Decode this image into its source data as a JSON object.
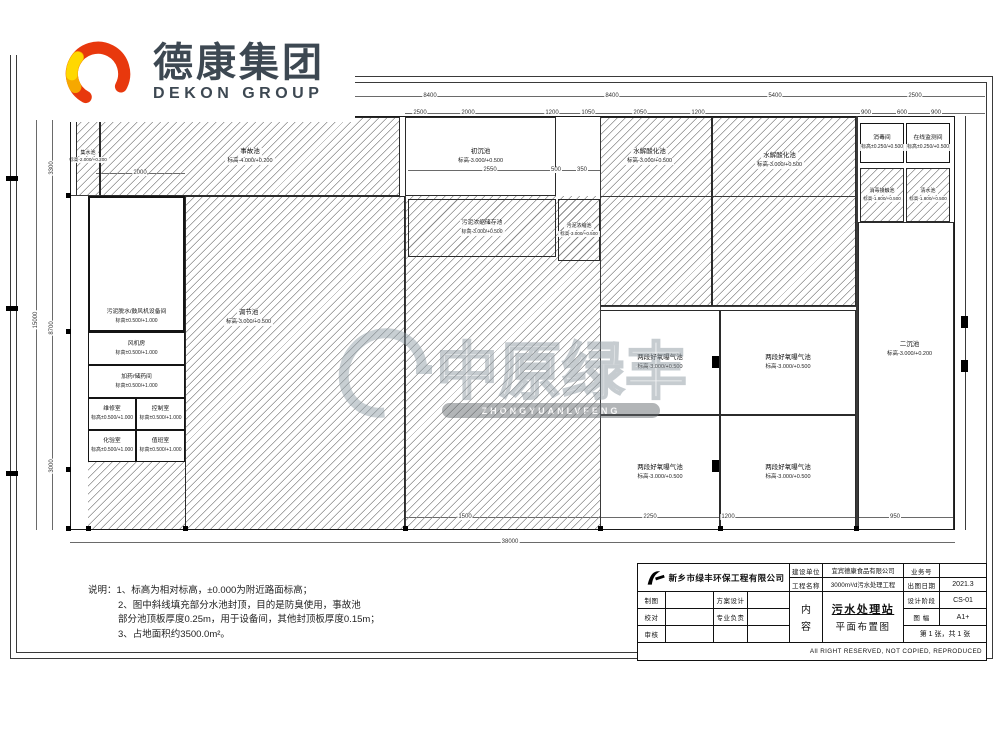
{
  "logo": {
    "cn": "德康集团",
    "en": "DEKON GROUP"
  },
  "watermark": {
    "cn": "中原绿丰",
    "en": "ZHONGYUANLVFENG"
  },
  "notes": {
    "line1": "说明：1、标高为相对标高，±0.000为附近路面标高；",
    "line2": "2、图中斜线填充部分水池封顶，目的是防臭使用，事故池",
    "line3": "部分池顶板厚度0.25m，用于设备间，其他封顶板厚度0.15m；",
    "line4": "3、占地面积约3500.0m²。"
  },
  "plan": {
    "tanks": [
      {
        "name": "事故池",
        "elev": "标高-4.000/+0.200"
      },
      {
        "name": "集水池",
        "elev": "标高-2.000/+0.200"
      },
      {
        "name": "调节池",
        "elev": "标高-3.000/+0.500"
      },
      {
        "name": "污泥浓缩储存池",
        "elev": "标高-3.000/+0.500"
      },
      {
        "name": "污泥浓缩池",
        "elev": "标高-3.000/+0.500"
      },
      {
        "name": "初沉池",
        "elev": "标高-3.000/+0.500"
      },
      {
        "name": "水解酸化池",
        "elev": "标高-3.000/+0.500"
      },
      {
        "name": "水解酸化池",
        "elev": "标高-3.000/+0.500"
      },
      {
        "name": "两段好氧曝气池",
        "elev": "标高-3.000/+0.500"
      },
      {
        "name": "两段好氧曝气池",
        "elev": "标高-3.000/+0.500"
      },
      {
        "name": "两段好氧曝气池",
        "elev": "标高-3.000/+0.500"
      },
      {
        "name": "两段好氧曝气池",
        "elev": "标高-3.000/+0.500"
      },
      {
        "name": "消毒间",
        "elev": "标高±0.250/+0.500"
      },
      {
        "name": "在线监测间",
        "elev": "标高±0.250/+0.500"
      },
      {
        "name": "消毒接触池",
        "elev": "标高-1.800/+0.500"
      },
      {
        "name": "清水池",
        "elev": "标高-1.800/+0.500"
      },
      {
        "name": "二沉池",
        "elev": "标高-3.000/+0.200"
      },
      {
        "name": "污泥脱水/鼓风机设备间",
        "elev": "标高±0.500/+1.000"
      },
      {
        "name": "风机房",
        "elev": "标高±0.500/+1.000"
      },
      {
        "name": "加药/储药间",
        "elev": "标高±0.500/+1.000"
      },
      {
        "name": "维修室",
        "elev": "标高±0.500/+1.000"
      },
      {
        "name": "控制室",
        "elev": "标高±0.500/+1.000"
      },
      {
        "name": "化验室",
        "elev": "标高±0.500/+1.000"
      },
      {
        "name": "值班室",
        "elev": "标高±0.500/+1.000"
      }
    ],
    "dims": {
      "t1a": "8400",
      "t1b": "8400",
      "t1c": "5400",
      "t1d": "2500",
      "t2a": "2500",
      "t2b": "2000",
      "t2c": "1200",
      "t2d": "1050",
      "t2e": "2050",
      "t2f": "1200",
      "t2g": "900",
      "t2h": "600",
      "t2i": "900",
      "m1": "2000",
      "m2": "2550",
      "m3": "500",
      "m4": "350",
      "b1": "1500",
      "b2": "2250",
      "b3": "1200",
      "b4": "950",
      "ob": "38000",
      "l1": "3300",
      "l2": "8700",
      "l3": "3000",
      "ol": "15000"
    }
  },
  "titleblock": {
    "company": "新乡市绿丰环保工程有限公司",
    "owner_label": "建设单位",
    "owner": "宜宾德康食品有限公司",
    "project_label": "工程名称",
    "project": "3000m³/d污水处理工程",
    "job_label": "业务号",
    "job": "",
    "date_label": "出图日期",
    "date": "2021.3",
    "stage_label": "设计阶段",
    "stage": "CS-01",
    "size_label": "图 幅",
    "size": "A1+",
    "sheet": "第 1 张，共 1 张",
    "draft_label": "制图",
    "scheme_label": "方案设计",
    "check_label": "校对",
    "lead_label": "专业负责",
    "review_label": "审核",
    "content_label_1": "内",
    "content_label_2": "容",
    "content_line1": "污水处理站",
    "content_line2": "平面布置图",
    "copyright": "All RIGHT RESERVED, NOT COPIED, REPRODUCED"
  }
}
